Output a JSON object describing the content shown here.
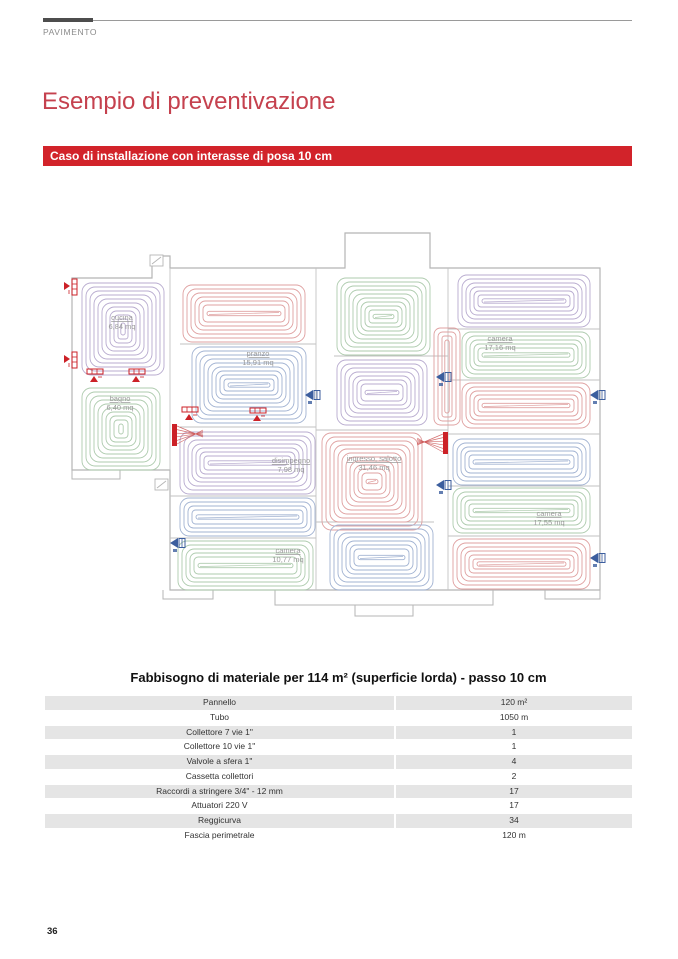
{
  "header": {
    "section_label": "PAVIMENTO"
  },
  "title": "Esempio di preventivazione",
  "banner": {
    "text": "Caso di installazione con interasse di posa 10 cm",
    "bg": "#d2232a"
  },
  "plan": {
    "colors": {
      "red": "#dfa0a0",
      "blue": "#a2b3d2",
      "green": "#aecbae",
      "purple": "#b8abcf",
      "wall": "#c2c2c2",
      "perimeter": "#b5b5b5",
      "label": "#9a9a9a",
      "manifold": "#cc2127",
      "valve_blue": "#3c5e9e",
      "valve_red": "#cc2127"
    },
    "zones": [
      {
        "id": "cucina",
        "color": "purple",
        "rect": [
          82,
          58,
          82,
          92
        ],
        "label": {
          "name": "cucina",
          "area": "6,84 mq",
          "x": 122,
          "y": 95
        }
      },
      {
        "id": "bagno",
        "color": "green",
        "rect": [
          82,
          163,
          78,
          82
        ],
        "label": {
          "name": "bagno",
          "area": "6,40 mq",
          "x": 120,
          "y": 176
        }
      },
      {
        "id": "zona-rossa-alto",
        "color": "red",
        "rect": [
          183,
          60,
          122,
          57
        ],
        "label": null
      },
      {
        "id": "pranzo",
        "color": "blue",
        "rect": [
          192,
          122,
          114,
          76
        ],
        "label": {
          "name": "pranzo",
          "area": "15,91 mq",
          "x": 258,
          "y": 131
        }
      },
      {
        "id": "disimpegno",
        "color": "purple",
        "rect": [
          180,
          207,
          135,
          62
        ],
        "label": {
          "name": "disimpegno",
          "area": "7,98 mq",
          "x": 291,
          "y": 238
        }
      },
      {
        "id": "zona-blu-sinistra",
        "color": "blue",
        "rect": [
          180,
          273,
          135,
          38
        ],
        "label": null
      },
      {
        "id": "camera-10",
        "color": "green",
        "rect": [
          178,
          316,
          135,
          49
        ],
        "label": {
          "name": "camera",
          "area": "10,77 mq",
          "x": 288,
          "y": 328
        }
      },
      {
        "id": "zona-verde-centro",
        "color": "green",
        "rect": [
          337,
          53,
          93,
          77
        ],
        "label": null
      },
      {
        "id": "zona-viola-centro",
        "color": "purple",
        "rect": [
          337,
          135,
          90,
          65
        ],
        "label": null
      },
      {
        "id": "corridoio",
        "color": "red",
        "rect": [
          434,
          103,
          26,
          97
        ],
        "label": null
      },
      {
        "id": "zona-viola-destra",
        "color": "purple",
        "rect": [
          458,
          50,
          132,
          52
        ],
        "label": null
      },
      {
        "id": "camera-17-16",
        "color": "green",
        "rect": [
          462,
          107,
          128,
          46
        ],
        "label": {
          "name": "camera",
          "area": "17,16 mq",
          "x": 500,
          "y": 116
        }
      },
      {
        "id": "zona-rossa-destra",
        "color": "red",
        "rect": [
          462,
          158,
          128,
          45
        ],
        "label": null
      },
      {
        "id": "ingresso-salotto",
        "color": "red",
        "rect": [
          322,
          208,
          100,
          97
        ],
        "label": {
          "name": "ingresso, salotto",
          "area": "31,46 mq",
          "x": 374,
          "y": 236
        }
      },
      {
        "id": "zona-blu-centro",
        "color": "blue",
        "rect": [
          330,
          300,
          103,
          65
        ],
        "label": null
      },
      {
        "id": "zona-blu-destra",
        "color": "blue",
        "rect": [
          453,
          214,
          137,
          46
        ],
        "label": null
      },
      {
        "id": "camera-17-55",
        "color": "green",
        "rect": [
          453,
          263,
          137,
          45
        ],
        "label": {
          "name": "camera",
          "area": "17,55 mq",
          "x": 549,
          "y": 291
        }
      },
      {
        "id": "zona-rossa-basso-destra",
        "color": "red",
        "rect": [
          453,
          314,
          137,
          50
        ],
        "label": null
      }
    ],
    "perimeter": "M72,53 H152 V31 H170 V43 H345 V8 H430 V43 H600 V365 H170 V245 H72 Z",
    "porches": [
      "M72,245 V254 H120 V245",
      "M163,365 V374 H213 V365",
      "M275,365 V380 H493 V365",
      "M355,380 V391 H413 V380",
      "M545,365 V374 H600 V365"
    ],
    "walls": [
      [
        170,
        43,
        170,
        245
      ],
      [
        316,
        43,
        316,
        365
      ],
      [
        448,
        43,
        448,
        365
      ],
      [
        180,
        119,
        316,
        119
      ],
      [
        180,
        202,
        316,
        202
      ],
      [
        170,
        271,
        316,
        271
      ],
      [
        170,
        313,
        316,
        313
      ],
      [
        334,
        131,
        448,
        131
      ],
      [
        316,
        205,
        448,
        205
      ],
      [
        316,
        297,
        434,
        297
      ],
      [
        448,
        104,
        600,
        104
      ],
      [
        448,
        155,
        600,
        155
      ],
      [
        448,
        209,
        600,
        209
      ],
      [
        448,
        261,
        600,
        261
      ],
      [
        448,
        311,
        600,
        311
      ]
    ],
    "manifolds": [
      {
        "x": 172,
        "y": 199,
        "dir": 1
      },
      {
        "x": 443,
        "y": 207,
        "dir": -1
      }
    ],
    "valves_blue": [
      [
        307,
        170
      ],
      [
        438,
        152
      ],
      [
        172,
        318
      ],
      [
        438,
        260
      ],
      [
        592,
        170
      ],
      [
        592,
        333
      ]
    ],
    "valves_red": [
      {
        "x": 95,
        "y": 153,
        "rot": 0
      },
      {
        "x": 137,
        "y": 153,
        "rot": 0
      },
      {
        "x": 190,
        "y": 191,
        "rot": 0
      },
      {
        "x": 258,
        "y": 192,
        "rot": 0
      },
      {
        "x": 68,
        "y": 62,
        "rot": 90
      },
      {
        "x": 68,
        "y": 135,
        "rot": 90
      }
    ],
    "windows": [
      [
        150,
        30
      ],
      [
        155,
        254
      ]
    ]
  },
  "table": {
    "title": "Fabbisogno di materiale per 114 m² (superficie lorda) - passo 10 cm",
    "rows": [
      {
        "label": "Pannello",
        "value": "120 m²"
      },
      {
        "label": "Tubo",
        "value": "1050 m"
      },
      {
        "label": "Collettore 7 vie 1\"",
        "value": "1"
      },
      {
        "label": "Collettore 10 vie 1\"",
        "value": "1"
      },
      {
        "label": "Valvole a sfera 1\"",
        "value": "4"
      },
      {
        "label": "Cassetta collettori",
        "value": "2"
      },
      {
        "label": "Raccordi a stringere 3/4\" - 12 mm",
        "value": "17"
      },
      {
        "label": "Attuatori 220 V",
        "value": "17"
      },
      {
        "label": "Reggicurva",
        "value": "34"
      },
      {
        "label": "Fascia perimetrale",
        "value": "120 m"
      }
    ]
  },
  "page_number": "36"
}
